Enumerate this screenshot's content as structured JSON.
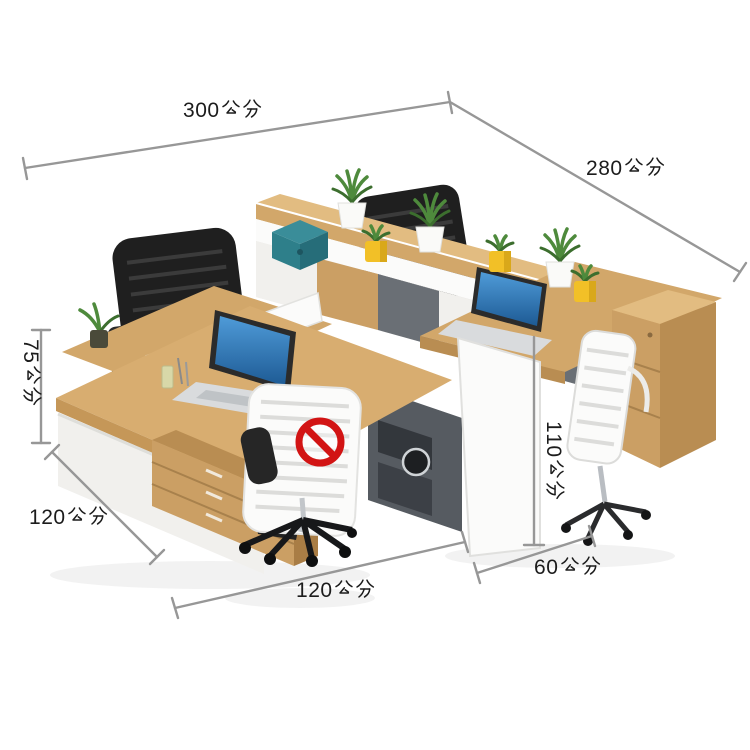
{
  "diagram": {
    "unit": "公分",
    "labels": {
      "top_width": "300公分",
      "depth": "280公分",
      "desk_height": "75公分",
      "left_depth": "120公分",
      "front_width": "120公分",
      "partition_height": "110公分",
      "cabinet_depth": "60公分"
    }
  },
  "colors": {
    "wood": "#d2a76a",
    "wood-dark": "#b98d52",
    "panel-white": "#f1f0ed",
    "cabinet-gray": "#565b61",
    "chair-black": "#1f1f1f",
    "box-teal": "#2e7f8a",
    "pot-yellow": "#f2c027",
    "plant-green": "#4e8a3c",
    "laptop-screen": "#2e79c2",
    "prohibition-red": "#d21414",
    "dimension-line": "#979797",
    "label-text": "#1c1c1c"
  }
}
